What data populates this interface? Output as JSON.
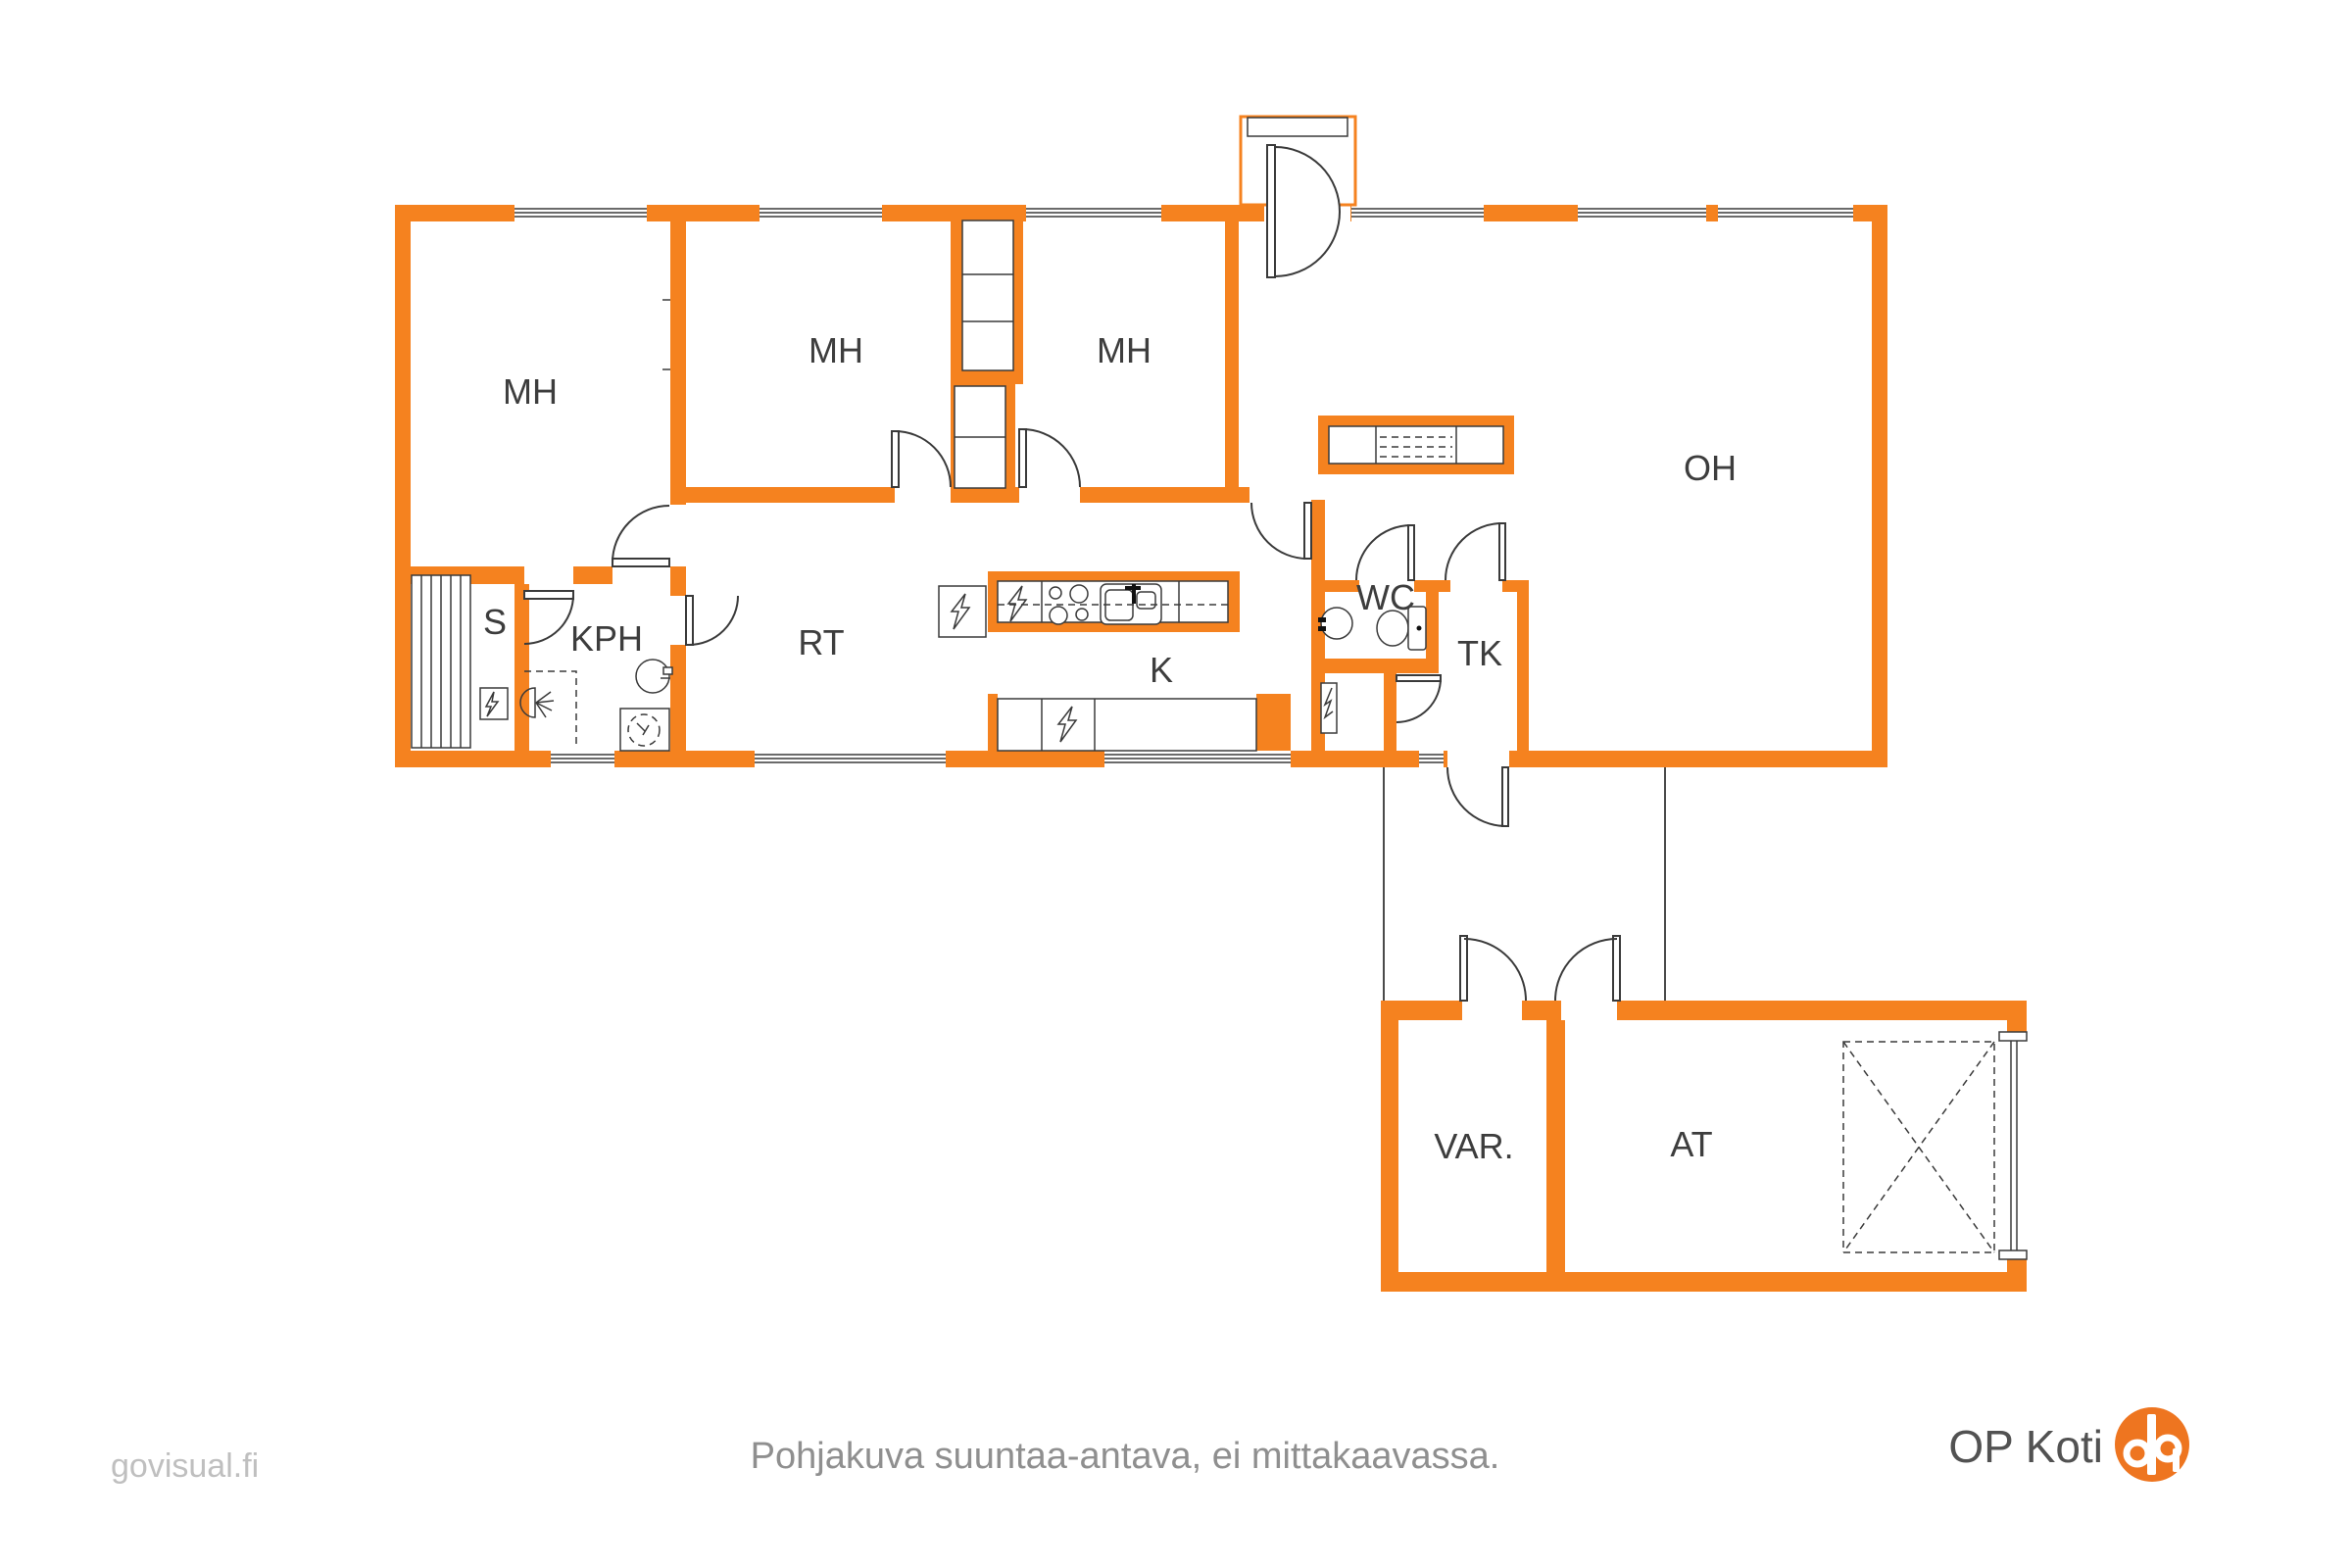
{
  "plan": {
    "rooms": [
      {
        "id": "mh-1",
        "label": "MH"
      },
      {
        "id": "mh-2",
        "label": "MH"
      },
      {
        "id": "mh-3",
        "label": "MH"
      },
      {
        "id": "oh",
        "label": "OH"
      },
      {
        "id": "s",
        "label": "S"
      },
      {
        "id": "kph",
        "label": "KPH"
      },
      {
        "id": "rt",
        "label": "RT"
      },
      {
        "id": "k",
        "label": "K"
      },
      {
        "id": "wc",
        "label": "WC"
      },
      {
        "id": "tk",
        "label": "TK"
      },
      {
        "id": "var",
        "label": "VAR."
      },
      {
        "id": "at",
        "label": "AT"
      }
    ],
    "caption": "Pohjakuva suuntaa-antava, ei mittakaavassa.",
    "watermark": "govisual.fi",
    "brand": {
      "name": "OP Koti"
    },
    "colors": {
      "wall": "#f5821f",
      "label": "#3d3d3d",
      "caption": "#8f8f8f",
      "watermark": "#bfbfbf",
      "brand_text": "#525252",
      "brand_orange": "#ee7520",
      "line": "#3a3a3a"
    }
  }
}
